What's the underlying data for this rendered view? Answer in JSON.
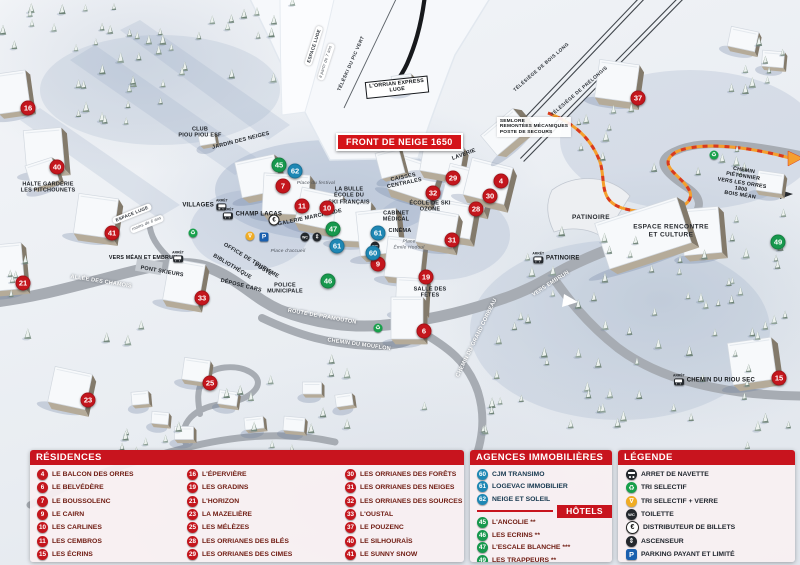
{
  "map": {
    "banner": "FRONT DE NEIGE 1650",
    "arret_label": "ARRÊT",
    "markers": [
      {
        "n": "4",
        "x": 501,
        "y": 181,
        "kind": "residence"
      },
      {
        "n": "6",
        "x": 424,
        "y": 331,
        "kind": "residence"
      },
      {
        "n": "7",
        "x": 283,
        "y": 186,
        "kind": "residence"
      },
      {
        "n": "9",
        "x": 378,
        "y": 264,
        "kind": "residence"
      },
      {
        "n": "10",
        "x": 327,
        "y": 208,
        "kind": "residence"
      },
      {
        "n": "11",
        "x": 302,
        "y": 206,
        "kind": "residence"
      },
      {
        "n": "15",
        "x": 779,
        "y": 378,
        "kind": "residence"
      },
      {
        "n": "16",
        "x": 28,
        "y": 108,
        "kind": "residence"
      },
      {
        "n": "19",
        "x": 426,
        "y": 277,
        "kind": "residence"
      },
      {
        "n": "21",
        "x": 23,
        "y": 283,
        "kind": "residence"
      },
      {
        "n": "23",
        "x": 88,
        "y": 400,
        "kind": "residence"
      },
      {
        "n": "25",
        "x": 210,
        "y": 383,
        "kind": "residence"
      },
      {
        "n": "28",
        "x": 476,
        "y": 209,
        "kind": "residence"
      },
      {
        "n": "29",
        "x": 453,
        "y": 178,
        "kind": "residence"
      },
      {
        "n": "30",
        "x": 490,
        "y": 196,
        "kind": "residence"
      },
      {
        "n": "31",
        "x": 452,
        "y": 240,
        "kind": "residence"
      },
      {
        "n": "32",
        "x": 433,
        "y": 193,
        "kind": "residence"
      },
      {
        "n": "33",
        "x": 202,
        "y": 298,
        "kind": "residence"
      },
      {
        "n": "37",
        "x": 638,
        "y": 98,
        "kind": "residence"
      },
      {
        "n": "40",
        "x": 57,
        "y": 167,
        "kind": "residence"
      },
      {
        "n": "41",
        "x": 112,
        "y": 233,
        "kind": "residence"
      },
      {
        "n": "45",
        "x": 279,
        "y": 165,
        "kind": "hotel"
      },
      {
        "n": "46",
        "x": 328,
        "y": 281,
        "kind": "hotel"
      },
      {
        "n": "47",
        "x": 333,
        "y": 229,
        "kind": "hotel"
      },
      {
        "n": "49",
        "x": 778,
        "y": 242,
        "kind": "hotel"
      },
      {
        "n": "60",
        "x": 373,
        "y": 253,
        "kind": "agence"
      },
      {
        "n": "61",
        "x": 378,
        "y": 233,
        "kind": "agence"
      },
      {
        "n": "61",
        "x": 337,
        "y": 246,
        "kind": "agence"
      },
      {
        "n": "62",
        "x": 295,
        "y": 171,
        "kind": "agence"
      }
    ],
    "labels": [
      {
        "text": "CLUB\nPIOU PIOU ESF",
        "x": 200,
        "y": 133,
        "rot": 0,
        "cls": "poi"
      },
      {
        "text": "JARDIN DES NEIGES",
        "x": 241,
        "y": 141,
        "rot": -14,
        "cls": "poi"
      },
      {
        "text": "HALTE GARDERIE\nLES PITCHOUNETS",
        "x": 48,
        "y": 188,
        "rot": 0,
        "cls": "poi"
      },
      {
        "text": "ESPACE LUGE",
        "x": 314,
        "y": 46,
        "rot": -72,
        "cls": "sign"
      },
      {
        "text": "à partir de 7 ans",
        "x": 326,
        "y": 62,
        "rot": -72,
        "cls": "sign-it"
      },
      {
        "text": "TÉLÉSKI DU PIC VERT",
        "x": 352,
        "y": 64,
        "rot": -66,
        "cls": "lift"
      },
      {
        "text": "L'ORRIAN EXPRESS\nLUGE",
        "x": 397,
        "y": 87,
        "rot": -6,
        "cls": "box"
      },
      {
        "text": "TÉLÉSIÈGE DE BOIS LONG",
        "x": 542,
        "y": 68,
        "rot": -41,
        "cls": "lift"
      },
      {
        "text": "TÉLÉSIÈGE DE PRÉLONGIS",
        "x": 580,
        "y": 92,
        "rot": -41,
        "cls": "lift"
      },
      {
        "text": "SEMLORE\nREMONTÉES MÉCANIQUES\nPOSTE DE SECOURS",
        "x": 534,
        "y": 127,
        "rot": 0,
        "cls": "boxl"
      },
      {
        "text": "ESPACE LUGE",
        "x": 132,
        "y": 214,
        "rot": -22,
        "cls": "sign"
      },
      {
        "text": "moins de 6 ans",
        "x": 147,
        "y": 224,
        "rot": -22,
        "cls": "sign-it"
      },
      {
        "text": "Place du festival",
        "x": 316,
        "y": 184,
        "rot": 0,
        "cls": "place"
      },
      {
        "text": "LA BULLE\nÉCOLE DU\nSKI FRANÇAIS",
        "x": 349,
        "y": 196,
        "rot": 0,
        "cls": "poi"
      },
      {
        "text": "GALERIE MARCHANDE",
        "x": 310,
        "y": 218,
        "rot": -12,
        "cls": "poi"
      },
      {
        "text": "CAISSES\nCENTRALES",
        "x": 404,
        "y": 181,
        "rot": -12,
        "cls": "poi"
      },
      {
        "text": "LAVERIE",
        "x": 464,
        "y": 155,
        "rot": -20,
        "cls": "poi"
      },
      {
        "text": "ÉCOLE DE SKI\nOZONE",
        "x": 430,
        "y": 207,
        "rot": 0,
        "cls": "poi"
      },
      {
        "text": "CABINET\nMÉDICAL",
        "x": 396,
        "y": 217,
        "rot": 0,
        "cls": "poi"
      },
      {
        "text": "CINÉMA",
        "x": 400,
        "y": 231,
        "rot": 0,
        "cls": "poi"
      },
      {
        "text": "Place\nÉmile Hodoul",
        "x": 409,
        "y": 245,
        "rot": 0,
        "cls": "place"
      },
      {
        "text": "OFFICE DE TOURISME",
        "x": 251,
        "y": 261,
        "rot": 31,
        "cls": "poi"
      },
      {
        "text": "BIBLIOTHÈQUE",
        "x": 232,
        "y": 267,
        "rot": 31,
        "cls": "poi"
      },
      {
        "text": "POSTE",
        "x": 263,
        "y": 270,
        "rot": 31,
        "cls": "poi"
      },
      {
        "text": "DÉPOSE CARS",
        "x": 241,
        "y": 286,
        "rot": 14,
        "cls": "poi"
      },
      {
        "text": "POLICE\nMUNICIPALE",
        "x": 285,
        "y": 289,
        "rot": 0,
        "cls": "poi"
      },
      {
        "text": "Place d'accueil",
        "x": 288,
        "y": 252,
        "rot": 0,
        "cls": "place"
      },
      {
        "text": "ALLÉE DES CHAMOIS",
        "x": 101,
        "y": 282,
        "rot": 9,
        "cls": "road"
      },
      {
        "text": "PONT SKIEURS",
        "x": 162,
        "y": 272,
        "rot": 10,
        "cls": "poi"
      },
      {
        "text": "VERS MÉAN ET EMBRUN",
        "x": 143,
        "y": 258,
        "rot": 0,
        "cls": "dir"
      },
      {
        "text": "PATINOIRE",
        "x": 591,
        "y": 218,
        "rot": 0,
        "cls": "poilg"
      },
      {
        "text": "ESPACE RENCONTRE\nET CULTURE",
        "x": 671,
        "y": 231,
        "rot": 0,
        "cls": "poilg"
      },
      {
        "text": "SALLE DES\nFÊTES",
        "x": 430,
        "y": 293,
        "rot": 0,
        "cls": "poi"
      },
      {
        "text": "ROUTE DE PRAMOUTON",
        "x": 322,
        "y": 317,
        "rot": 10,
        "cls": "road"
      },
      {
        "text": "CHEMIN DU MOUFLON",
        "x": 359,
        "y": 345,
        "rot": 8,
        "cls": "road"
      },
      {
        "text": "CHEMIN DU GRAND CORBEAU",
        "x": 477,
        "y": 338,
        "rot": -64,
        "cls": "road"
      },
      {
        "text": "VERS EMBRUN",
        "x": 551,
        "y": 284,
        "rot": -33,
        "cls": "road"
      },
      {
        "text": "CHEMIN PIÉTONNIER\nVERS LES ORRES 1800\nBOIS MÉAN",
        "x": 742,
        "y": 183,
        "rot": 9,
        "cls": "dir"
      }
    ],
    "bus_stops": [
      {
        "name": "VILLAGES",
        "x": 205,
        "y": 205,
        "icon_side": "right"
      },
      {
        "name": "CHAMP LACAS",
        "x": 252,
        "y": 214,
        "icon_side": "left"
      },
      {
        "name": "PATINOIRE",
        "x": 556,
        "y": 258,
        "icon_side": "left"
      },
      {
        "name": "CHEMIN DU RIOU SEC",
        "x": 714,
        "y": 380,
        "icon_side": "left"
      },
      {
        "name": "",
        "x": 178,
        "y": 257,
        "icon_side": "only"
      }
    ],
    "icons": [
      {
        "kind": "tri-selectif-verre-icon",
        "x": 250,
        "y": 236
      },
      {
        "kind": "parking-icon",
        "x": 264,
        "y": 237
      },
      {
        "kind": "distributeur-icon",
        "x": 274,
        "y": 220
      },
      {
        "kind": "toilette-icon",
        "x": 305,
        "y": 237
      },
      {
        "kind": "ascenseur-icon",
        "x": 317,
        "y": 237
      },
      {
        "kind": "toilette-icon",
        "x": 375,
        "y": 246
      },
      {
        "kind": "tri-selectif-icon",
        "x": 193,
        "y": 233
      },
      {
        "kind": "tri-selectif-icon",
        "x": 378,
        "y": 328
      },
      {
        "kind": "tri-selectif-icon",
        "x": 714,
        "y": 155
      }
    ]
  },
  "legend": {
    "residences": {
      "title": "RÉSIDENCES",
      "items": [
        {
          "n": "4",
          "label": "LE BALCON DES ORRES"
        },
        {
          "n": "6",
          "label": "LE BELVÉDÈRE"
        },
        {
          "n": "7",
          "label": "LE BOUSSOLENC"
        },
        {
          "n": "9",
          "label": "LE CAIRN"
        },
        {
          "n": "10",
          "label": "LES CARLINES"
        },
        {
          "n": "11",
          "label": "LES CEMBROS"
        },
        {
          "n": "15",
          "label": "LES ÉCRINS"
        },
        {
          "n": "16",
          "label": "L'ÉPERVIÈRE"
        },
        {
          "n": "19",
          "label": "LES GRADINS"
        },
        {
          "n": "21",
          "label": "L'HORIZON"
        },
        {
          "n": "23",
          "label": "LA MAZELIÈRE"
        },
        {
          "n": "25",
          "label": "LES MÉLÈZES"
        },
        {
          "n": "28",
          "label": "LES ORRIANES DES BLÉS"
        },
        {
          "n": "29",
          "label": "LES ORRIANES DES CIMES"
        },
        {
          "n": "30",
          "label": "LES ORRIANES DES FORÊTS"
        },
        {
          "n": "31",
          "label": "LES ORRIANES DES NEIGES"
        },
        {
          "n": "32",
          "label": "LES ORRIANES DES SOURCES"
        },
        {
          "n": "33",
          "label": "L'OUSTAL"
        },
        {
          "n": "37",
          "label": "LE POUZENC"
        },
        {
          "n": "40",
          "label": "LE SILHOURAÏS"
        },
        {
          "n": "41",
          "label": "LE SUNNY SNOW"
        }
      ]
    },
    "agences": {
      "title": "AGENCES IMMOBILIÈRES",
      "items": [
        {
          "n": "60",
          "label": "CJM TRANSIMO"
        },
        {
          "n": "61",
          "label": "LOGEVAC IMMOBILIER"
        },
        {
          "n": "62",
          "label": "NEIGE ET SOLEIL"
        }
      ]
    },
    "hotels": {
      "title": "HÔTELS",
      "items": [
        {
          "n": "45",
          "label": "L'ANCOLIE **"
        },
        {
          "n": "46",
          "label": "LES ECRINS **"
        },
        {
          "n": "47",
          "label": "L'ESCALE BLANCHE ***"
        },
        {
          "n": "49",
          "label": "LES TRAPPEURS **"
        }
      ]
    },
    "legende": {
      "title": "LÉGENDE",
      "items": [
        {
          "icon": "navette-icon",
          "label": "ARRET DE NAVETTE"
        },
        {
          "icon": "tri-selectif-icon",
          "label": "TRI SELECTIF"
        },
        {
          "icon": "tri-selectif-verre-icon",
          "label": "TRI SELECTIF + VERRE"
        },
        {
          "icon": "toilette-icon",
          "label": "TOILETTE"
        },
        {
          "icon": "distributeur-icon",
          "label": "DISTRIBUTEUR DE BILLETS"
        },
        {
          "icon": "ascenseur-icon",
          "label": "ASCENSEUR"
        },
        {
          "icon": "parking-icon",
          "label": "PARKING PAYANT ET LIMITÉ"
        }
      ]
    }
  },
  "colors": {
    "residence": "#c4161d",
    "hotel": "#17984d",
    "agence": "#1e87b4",
    "header_red": "#c8141e",
    "path_orange": "#f59f2e",
    "path_red_dash": "#d93a1e"
  }
}
